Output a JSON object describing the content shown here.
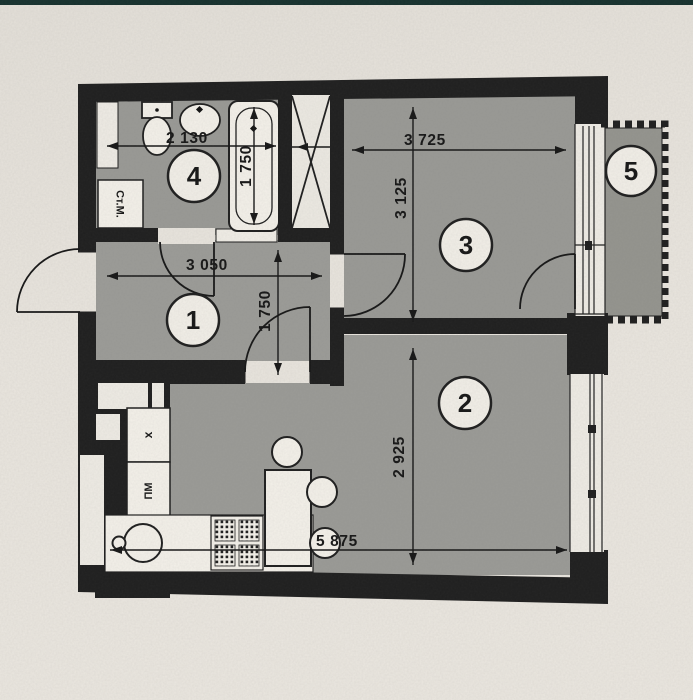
{
  "photo": {
    "top_strip_color": "#16312e",
    "paper_color": "#e9e5de",
    "wall_color": "#1f1f1f",
    "floor_color": "#9a9a96"
  },
  "plan": {
    "rooms": [
      {
        "label": "1"
      },
      {
        "label": "2"
      },
      {
        "label": "3"
      },
      {
        "label": "4"
      },
      {
        "label": "5"
      }
    ],
    "dimensions": {
      "bathroom_width": "2 130",
      "bathtub_length": "1 750",
      "hallway_width": "3 050",
      "hallway_depth": "1 750",
      "room3_width": "3 725",
      "room3_depth": "3 125",
      "room2_depth": "2 925",
      "room2_width": "5 875"
    },
    "labels": {
      "washing_machine": "Ст.М.",
      "fridge": "x",
      "dishwasher": "ПМ"
    }
  }
}
